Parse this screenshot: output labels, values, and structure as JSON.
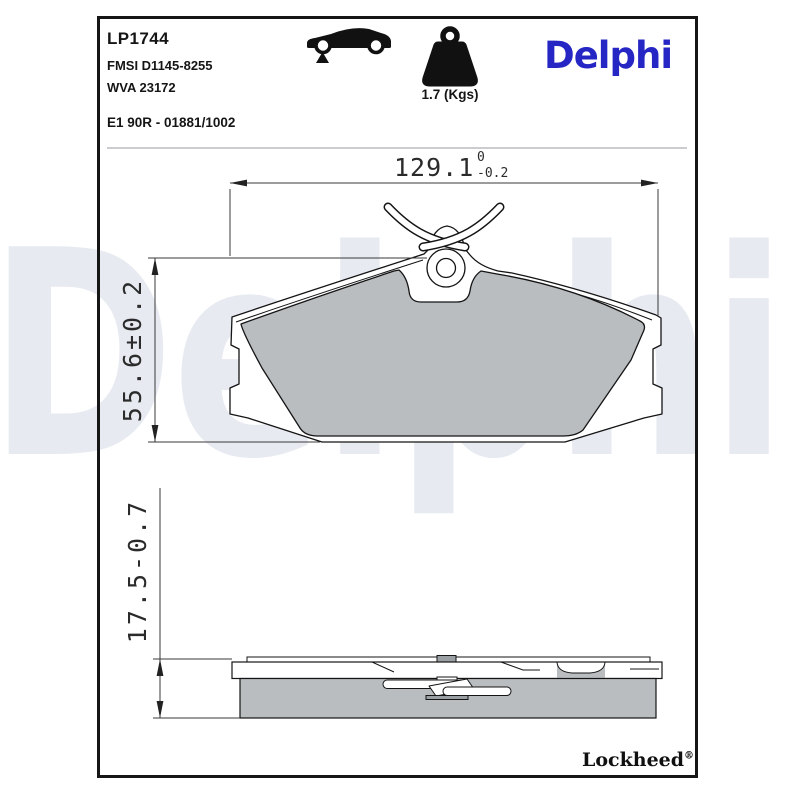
{
  "header": {
    "part_number": "LP1744",
    "fmsi_ref": "FMSI D1145-8255",
    "wva_ref": "WVA 23172",
    "homologation": "E1 90R - 01881/1002"
  },
  "weight": {
    "label": "1.7 (Kgs)"
  },
  "brand": {
    "logo_text": "Delphi",
    "watermark_text": "Delphi",
    "logo_color": "#2626c4"
  },
  "footer": {
    "brand": "Lockheed",
    "registered": "®"
  },
  "dimensions": {
    "width": {
      "nominal": "129.1",
      "upper_tol": "0",
      "lower_tol": "-0.2"
    },
    "height": {
      "label": "55.6±0.2"
    },
    "thickness": {
      "label": "17.5-0.7"
    }
  },
  "icons": {
    "car": "car-silhouette-front-axle-marker",
    "weight": "calibration-weight"
  },
  "colors": {
    "friction": "#b9bdc0",
    "plate": "#ffffff",
    "clip_metal": "#9ba0a5",
    "accent_blue": "#2626c4",
    "watermark": "#e7eaf1",
    "outline": "#141414"
  }
}
